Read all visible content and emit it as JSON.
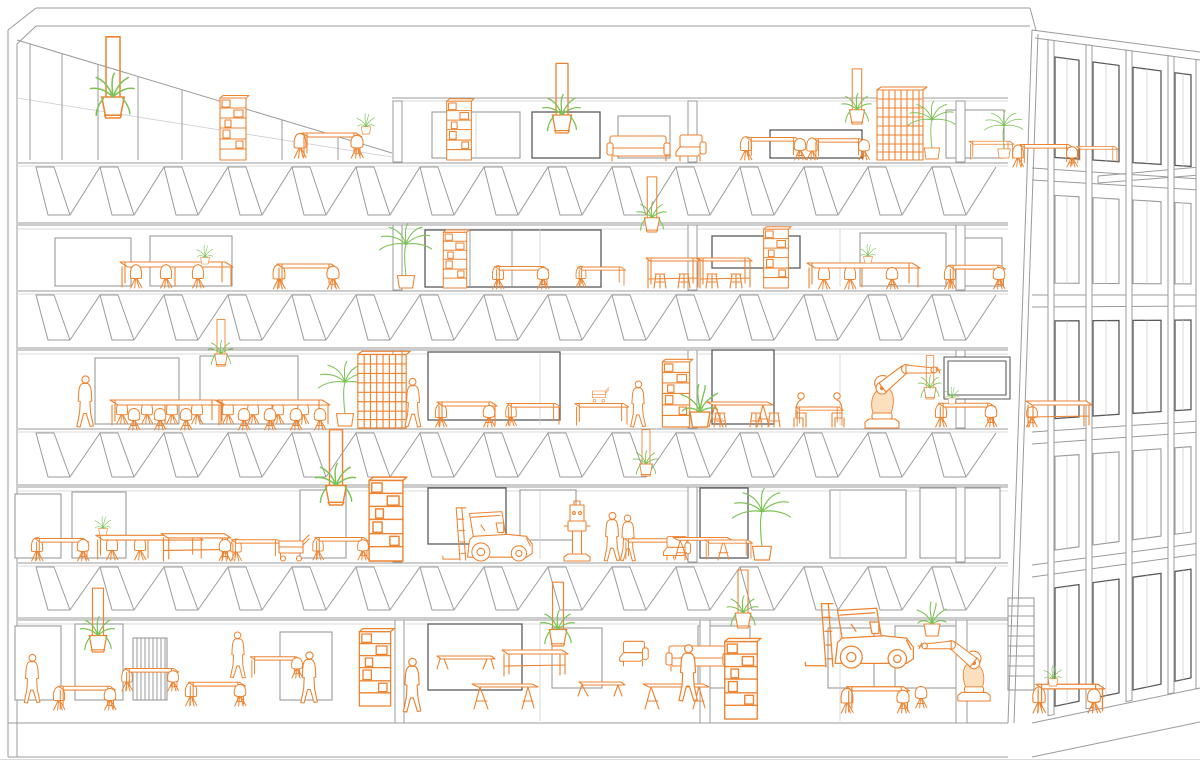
{
  "meta": {
    "title": "Perspective building section: five floors of a concrete-frame workspace with orange line-drawn furniture, industrial robots, forklifts, people and green plants",
    "drawing_type": "architectural-line-drawing"
  },
  "palette": {
    "background": "#ffffff",
    "line": "#9b9b9b",
    "line_light": "#cfcfd2",
    "line_dark": "#5a5a5e",
    "furniture": "#ee8330",
    "furniture_fill": "#fbe0c0",
    "plant": "#7cc356"
  },
  "scene": {
    "floors": [
      {
        "level": 5,
        "floor_y": 160
      },
      {
        "level": 4,
        "floor_y": 289
      },
      {
        "level": 3,
        "floor_y": 427
      },
      {
        "level": 2,
        "floor_y": 561
      },
      {
        "level": 1,
        "floor_y": 723
      }
    ],
    "items": [
      {
        "t": "hanging-planter",
        "x": 113,
        "y": 118,
        "s": 1.4
      },
      {
        "t": "shelf-unit",
        "x": 233,
        "y": 160,
        "s": 1
      },
      {
        "t": "chair-back",
        "x": 300,
        "y": 158,
        "s": 0.95
      },
      {
        "t": "table",
        "x": 330,
        "y": 158,
        "s": 1
      },
      {
        "t": "chair",
        "x": 357,
        "y": 158,
        "s": 0.95
      },
      {
        "t": "potted-plant",
        "x": 366,
        "y": 134,
        "s": 0.6
      },
      {
        "t": "shelf-unit",
        "x": 459,
        "y": 160,
        "s": 0.95
      },
      {
        "t": "hanging-planter",
        "x": 562,
        "y": 133,
        "s": 1.2
      },
      {
        "t": "sofa",
        "x": 640,
        "y": 161,
        "s": 1
      },
      {
        "t": "armchair",
        "x": 690,
        "y": 161,
        "s": 1,
        "f": 1
      },
      {
        "t": "chair-back",
        "x": 746,
        "y": 160,
        "s": 0.9
      },
      {
        "t": "table",
        "x": 772,
        "y": 160,
        "s": 0.9
      },
      {
        "t": "chair",
        "x": 800,
        "y": 160,
        "s": 0.9
      },
      {
        "t": "chair-back",
        "x": 812,
        "y": 160,
        "s": 0.85
      },
      {
        "t": "table",
        "x": 838,
        "y": 160,
        "s": 0.85
      },
      {
        "t": "chair",
        "x": 864,
        "y": 160,
        "s": 0.85
      },
      {
        "t": "hanging-planter",
        "x": 857,
        "y": 124,
        "s": 0.95
      },
      {
        "t": "lattice-screen",
        "x": 900,
        "y": 160,
        "s": 1
      },
      {
        "t": "palm-plant",
        "x": 932,
        "y": 159,
        "s": 0.85
      },
      {
        "t": "table",
        "x": 990,
        "y": 160,
        "s": 0.75
      },
      {
        "t": "palm-plant",
        "x": 1004,
        "y": 158,
        "s": 0.7
      },
      {
        "t": "chair-back",
        "x": 1018,
        "y": 167,
        "s": 0.85
      },
      {
        "t": "table",
        "x": 1045,
        "y": 167,
        "s": 0.9
      },
      {
        "t": "chair",
        "x": 1072,
        "y": 167,
        "s": 0.85
      },
      {
        "t": "table",
        "x": 1096,
        "y": 164,
        "s": 0.7
      },
      {
        "t": "long-table",
        "x": 175,
        "y": 288,
        "s": 1
      },
      {
        "t": "chair-back",
        "x": 136,
        "y": 288,
        "s": 0.9
      },
      {
        "t": "chair-back",
        "x": 166,
        "y": 288,
        "s": 0.9
      },
      {
        "t": "chair-back",
        "x": 198,
        "y": 288,
        "s": 0.9
      },
      {
        "t": "potted-plant",
        "x": 205,
        "y": 264,
        "s": 0.55
      },
      {
        "t": "chair-back",
        "x": 279,
        "y": 289,
        "s": 0.95
      },
      {
        "t": "table",
        "x": 305,
        "y": 289,
        "s": 1
      },
      {
        "t": "chair",
        "x": 333,
        "y": 289,
        "s": 0.95
      },
      {
        "t": "palm-plant",
        "x": 406,
        "y": 288,
        "s": 0.95
      },
      {
        "t": "shelf-unit",
        "x": 455,
        "y": 288,
        "s": 0.9
      },
      {
        "t": "chair-back",
        "x": 498,
        "y": 289,
        "s": 0.9
      },
      {
        "t": "table",
        "x": 520,
        "y": 289,
        "s": 0.9
      },
      {
        "t": "chair",
        "x": 543,
        "y": 289,
        "s": 0.9
      },
      {
        "t": "chair-back",
        "x": 581,
        "y": 287,
        "s": 0.8
      },
      {
        "t": "table",
        "x": 600,
        "y": 287,
        "s": 0.8
      },
      {
        "t": "hanging-planter",
        "x": 652,
        "y": 232,
        "s": 0.95
      },
      {
        "t": "stool",
        "x": 660,
        "y": 288,
        "s": 1
      },
      {
        "t": "high-table",
        "x": 672,
        "y": 288,
        "s": 1
      },
      {
        "t": "stool",
        "x": 684,
        "y": 288,
        "s": 1
      },
      {
        "t": "stool",
        "x": 712,
        "y": 288,
        "s": 1
      },
      {
        "t": "high-table",
        "x": 724,
        "y": 288,
        "s": 1
      },
      {
        "t": "stool",
        "x": 736,
        "y": 288,
        "s": 1
      },
      {
        "t": "shelf-unit",
        "x": 776,
        "y": 288,
        "s": 0.95
      },
      {
        "t": "chair-back",
        "x": 824,
        "y": 289,
        "s": 0.9
      },
      {
        "t": "chair-back",
        "x": 850,
        "y": 289,
        "s": 0.9
      },
      {
        "t": "long-table",
        "x": 862,
        "y": 289,
        "s": 1
      },
      {
        "t": "chair",
        "x": 892,
        "y": 289,
        "s": 0.9
      },
      {
        "t": "potted-plant",
        "x": 868,
        "y": 263,
        "s": 0.55
      },
      {
        "t": "chair-back",
        "x": 950,
        "y": 289,
        "s": 0.9
      },
      {
        "t": "table",
        "x": 975,
        "y": 289,
        "s": 0.95
      },
      {
        "t": "chair",
        "x": 999,
        "y": 289,
        "s": 0.9
      },
      {
        "t": "person",
        "x": 85,
        "y": 427,
        "s": 1
      },
      {
        "t": "chair-back",
        "x": 122,
        "y": 424,
        "s": 0.88
      },
      {
        "t": "chair-back",
        "x": 147,
        "y": 424,
        "s": 0.88
      },
      {
        "t": "chair-back",
        "x": 172,
        "y": 424,
        "s": 0.88
      },
      {
        "t": "chair-back",
        "x": 197,
        "y": 424,
        "s": 0.88
      },
      {
        "t": "chair-back",
        "x": 228,
        "y": 424,
        "s": 0.88
      },
      {
        "t": "chair-back",
        "x": 253,
        "y": 424,
        "s": 0.88
      },
      {
        "t": "chair-back",
        "x": 278,
        "y": 424,
        "s": 0.88
      },
      {
        "t": "chair-back",
        "x": 303,
        "y": 424,
        "s": 0.88
      },
      {
        "t": "long-table",
        "x": 165,
        "y": 426,
        "s": 1
      },
      {
        "t": "long-table",
        "x": 272,
        "y": 426,
        "s": 1
      },
      {
        "t": "chair",
        "x": 134,
        "y": 430,
        "s": 0.9
      },
      {
        "t": "chair",
        "x": 160,
        "y": 430,
        "s": 0.9
      },
      {
        "t": "chair",
        "x": 186,
        "y": 430,
        "s": 0.9
      },
      {
        "t": "chair",
        "x": 244,
        "y": 430,
        "s": 0.9
      },
      {
        "t": "chair",
        "x": 270,
        "y": 430,
        "s": 0.9
      },
      {
        "t": "chair",
        "x": 296,
        "y": 430,
        "s": 0.9
      },
      {
        "t": "chair",
        "x": 320,
        "y": 430,
        "s": 0.9
      },
      {
        "t": "hanging-planter",
        "x": 221,
        "y": 366,
        "s": 0.8
      },
      {
        "t": "palm-plant",
        "x": 345,
        "y": 426,
        "s": 0.95
      },
      {
        "t": "lattice-screen",
        "x": 382,
        "y": 428,
        "s": 1.05
      },
      {
        "t": "person",
        "x": 413,
        "y": 427,
        "s": 0.95,
        "f": 1
      },
      {
        "t": "chair-back",
        "x": 441,
        "y": 427,
        "s": 0.9
      },
      {
        "t": "table",
        "x": 465,
        "y": 427,
        "s": 1
      },
      {
        "t": "chair",
        "x": 489,
        "y": 427,
        "s": 0.9
      },
      {
        "t": "chair-back",
        "x": 511,
        "y": 426,
        "s": 0.85
      },
      {
        "t": "table",
        "x": 532,
        "y": 426,
        "s": 0.9
      },
      {
        "t": "table",
        "x": 600,
        "y": 426,
        "s": 0.9
      },
      {
        "t": "cart",
        "x": 600,
        "y": 402,
        "s": 0.55
      },
      {
        "t": "person",
        "x": 638,
        "y": 427,
        "s": 0.9
      },
      {
        "t": "shelf-unit",
        "x": 676,
        "y": 427,
        "s": 1.05
      },
      {
        "t": "potted-plant",
        "x": 700,
        "y": 427,
        "s": 1.25
      },
      {
        "t": "stool",
        "x": 720,
        "y": 427,
        "s": 1
      },
      {
        "t": "trestle-table",
        "x": 737,
        "y": 427,
        "s": 1
      },
      {
        "t": "stool",
        "x": 756,
        "y": 427,
        "s": 1
      },
      {
        "t": "stool",
        "x": 774,
        "y": 427,
        "s": 1
      },
      {
        "t": "seated-person",
        "x": 800,
        "y": 427,
        "s": 1
      },
      {
        "t": "table",
        "x": 818,
        "y": 427,
        "s": 0.8
      },
      {
        "t": "seated-person",
        "x": 838,
        "y": 427,
        "s": 1,
        "f": 1
      },
      {
        "t": "robot-arm",
        "x": 882,
        "y": 428,
        "s": 1
      },
      {
        "t": "hanging-planter",
        "x": 930,
        "y": 399,
        "s": 0.75
      },
      {
        "t": "whiteboard",
        "x": 977,
        "y": 401,
        "s": 1,
        "c": "s"
      },
      {
        "t": "chair-back",
        "x": 941,
        "y": 427,
        "s": 0.9
      },
      {
        "t": "table",
        "x": 965,
        "y": 427,
        "s": 0.95
      },
      {
        "t": "chair",
        "x": 991,
        "y": 427,
        "s": 0.9
      },
      {
        "t": "potted-plant",
        "x": 952,
        "y": 404,
        "s": 0.5
      },
      {
        "t": "chair",
        "x": 1032,
        "y": 427,
        "s": 0.85,
        "f": 1
      },
      {
        "t": "workbench",
        "x": 1058,
        "y": 427,
        "s": 1
      },
      {
        "t": "chair-back",
        "x": 37,
        "y": 561,
        "s": 0.9
      },
      {
        "t": "table",
        "x": 60,
        "y": 561,
        "s": 0.9
      },
      {
        "t": "chair",
        "x": 83,
        "y": 561,
        "s": 0.9
      },
      {
        "t": "chair-back",
        "x": 112,
        "y": 560,
        "s": 0.9
      },
      {
        "t": "chair-back",
        "x": 140,
        "y": 560,
        "s": 0.9
      },
      {
        "t": "long-table",
        "x": 148,
        "y": 560,
        "s": 0.95
      },
      {
        "t": "potted-plant",
        "x": 103,
        "y": 535,
        "s": 0.55
      },
      {
        "t": "workbench",
        "x": 195,
        "y": 561,
        "s": 1.05
      },
      {
        "t": "chair",
        "x": 225,
        "y": 561,
        "s": 0.9,
        "f": 1
      },
      {
        "t": "chair-back",
        "x": 236,
        "y": 561,
        "s": 0.85
      },
      {
        "t": "table",
        "x": 255,
        "y": 561,
        "s": 0.85
      },
      {
        "t": "cart",
        "x": 293,
        "y": 561,
        "s": 1
      },
      {
        "t": "chair-back",
        "x": 318,
        "y": 560,
        "s": 0.85
      },
      {
        "t": "table",
        "x": 340,
        "y": 560,
        "s": 0.9
      },
      {
        "t": "chair",
        "x": 363,
        "y": 560,
        "s": 0.85
      },
      {
        "t": "hanging-planter",
        "x": 336,
        "y": 505,
        "s": 1.3
      },
      {
        "t": "shelf-unit",
        "x": 386,
        "y": 561,
        "s": 1.3
      },
      {
        "t": "forklift",
        "x": 498,
        "y": 561,
        "s": 0.95
      },
      {
        "t": "machine",
        "x": 577,
        "y": 561,
        "s": 1
      },
      {
        "t": "person",
        "x": 612,
        "y": 561,
        "s": 0.95
      },
      {
        "t": "person",
        "x": 628,
        "y": 561,
        "s": 0.9,
        "f": 1
      },
      {
        "t": "hanging-planter",
        "x": 646,
        "y": 476,
        "s": 0.8
      },
      {
        "t": "table",
        "x": 648,
        "y": 560,
        "s": 0.85
      },
      {
        "t": "armchair",
        "x": 676,
        "y": 560,
        "s": 0.9,
        "f": 1
      },
      {
        "t": "trestle-table",
        "x": 700,
        "y": 560,
        "s": 0.9
      },
      {
        "t": "table",
        "x": 727,
        "y": 560,
        "s": 0.8
      },
      {
        "t": "palm-plant",
        "x": 762,
        "y": 560,
        "s": 1.05
      },
      {
        "t": "person",
        "x": 32,
        "y": 703,
        "s": 0.95
      },
      {
        "t": "hanging-planter",
        "x": 98,
        "y": 652,
        "s": 1.1
      },
      {
        "t": "chair-back",
        "x": 59,
        "y": 710,
        "s": 0.9
      },
      {
        "t": "table",
        "x": 85,
        "y": 710,
        "s": 0.95
      },
      {
        "t": "chair",
        "x": 110,
        "y": 710,
        "s": 0.9
      },
      {
        "t": "chair-back",
        "x": 127,
        "y": 691,
        "s": 0.85
      },
      {
        "t": "table",
        "x": 150,
        "y": 691,
        "s": 0.9
      },
      {
        "t": "chair",
        "x": 173,
        "y": 691,
        "s": 0.85
      },
      {
        "t": "chair-back",
        "x": 191,
        "y": 706,
        "s": 0.9
      },
      {
        "t": "table",
        "x": 215,
        "y": 706,
        "s": 0.95
      },
      {
        "t": "chair",
        "x": 240,
        "y": 706,
        "s": 0.9
      },
      {
        "t": "person",
        "x": 238,
        "y": 678,
        "s": 0.9,
        "f": 1
      },
      {
        "t": "table",
        "x": 274,
        "y": 678,
        "s": 0.85
      },
      {
        "t": "chair",
        "x": 297,
        "y": 678,
        "s": 0.85
      },
      {
        "t": "person",
        "x": 309,
        "y": 703,
        "s": 1
      },
      {
        "t": "shelf-unit",
        "x": 375,
        "y": 706,
        "s": 1.2
      },
      {
        "t": "person",
        "x": 412,
        "y": 712,
        "s": 1.05
      },
      {
        "t": "bench",
        "x": 465,
        "y": 669,
        "s": 1
      },
      {
        "t": "trestle-table",
        "x": 502,
        "y": 709,
        "s": 1
      },
      {
        "t": "workbench",
        "x": 534,
        "y": 676,
        "s": 1
      },
      {
        "t": "hanging-planter",
        "x": 558,
        "y": 646,
        "s": 1.1
      },
      {
        "t": "coffee-table",
        "x": 601,
        "y": 696,
        "s": 1
      },
      {
        "t": "armchair",
        "x": 633,
        "y": 666,
        "s": 0.95,
        "f": 1
      },
      {
        "t": "trestle-table",
        "x": 673,
        "y": 709,
        "s": 1
      },
      {
        "t": "sofa",
        "x": 699,
        "y": 671,
        "s": 1
      },
      {
        "t": "hanging-planter",
        "x": 743,
        "y": 628,
        "s": 1
      },
      {
        "t": "shelf-unit",
        "x": 741,
        "y": 719,
        "s": 1.25
      },
      {
        "t": "person",
        "x": 688,
        "y": 701,
        "s": 1.1
      },
      {
        "t": "forklift",
        "x": 872,
        "y": 668,
        "s": 1.15
      },
      {
        "t": "chair-back",
        "x": 847,
        "y": 713,
        "s": 0.95
      },
      {
        "t": "table",
        "x": 876,
        "y": 713,
        "s": 1.05
      },
      {
        "t": "chair",
        "x": 903,
        "y": 713,
        "s": 0.95
      },
      {
        "t": "chair",
        "x": 921,
        "y": 708,
        "s": 0.9
      },
      {
        "t": "potted-plant",
        "x": 932,
        "y": 636,
        "s": 1
      },
      {
        "t": "robot-arm",
        "x": 974,
        "y": 701,
        "s": 0.95,
        "f": 1
      },
      {
        "t": "chair-back",
        "x": 1039,
        "y": 713,
        "s": 1
      },
      {
        "t": "table",
        "x": 1068,
        "y": 713,
        "s": 1.15
      },
      {
        "t": "chair",
        "x": 1094,
        "y": 713,
        "s": 1
      },
      {
        "t": "potted-plant",
        "x": 1053,
        "y": 686,
        "s": 0.6
      }
    ]
  }
}
